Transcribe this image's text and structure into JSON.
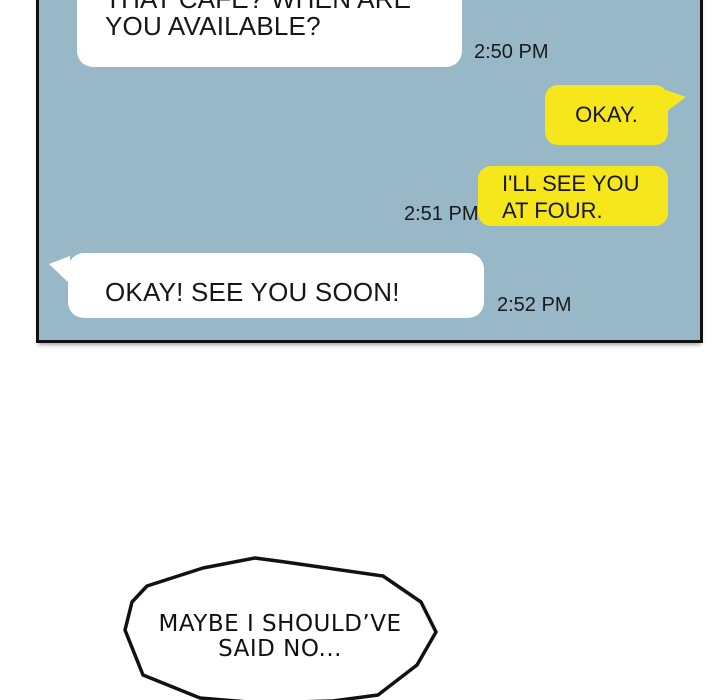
{
  "page": {
    "background_color": "#ffffff"
  },
  "chat_panel": {
    "background_color": "#98b7c7",
    "border_color": "#111111",
    "bubble_colors": {
      "incoming": "#ffffff",
      "outgoing": "#f6e71d"
    },
    "text_color": "#161616",
    "messages": [
      {
        "direction": "incoming",
        "lines": [
          "THAT CAFE? WHEN ARE",
          "YOU AVAILABLE?"
        ],
        "timestamp": "2:50 PM"
      },
      {
        "direction": "outgoing",
        "lines": [
          "OKAY."
        ],
        "timestamp": ""
      },
      {
        "direction": "outgoing",
        "lines": [
          "I'LL SEE YOU",
          "AT FOUR."
        ],
        "timestamp": "2:51 PM"
      },
      {
        "direction": "incoming",
        "lines": [
          "OKAY! SEE YOU SOON!"
        ],
        "timestamp": "2:52 PM"
      }
    ]
  },
  "thought_bubble": {
    "lines": [
      "MAYBE I SHOULD’VE",
      "SAID NO..."
    ]
  }
}
